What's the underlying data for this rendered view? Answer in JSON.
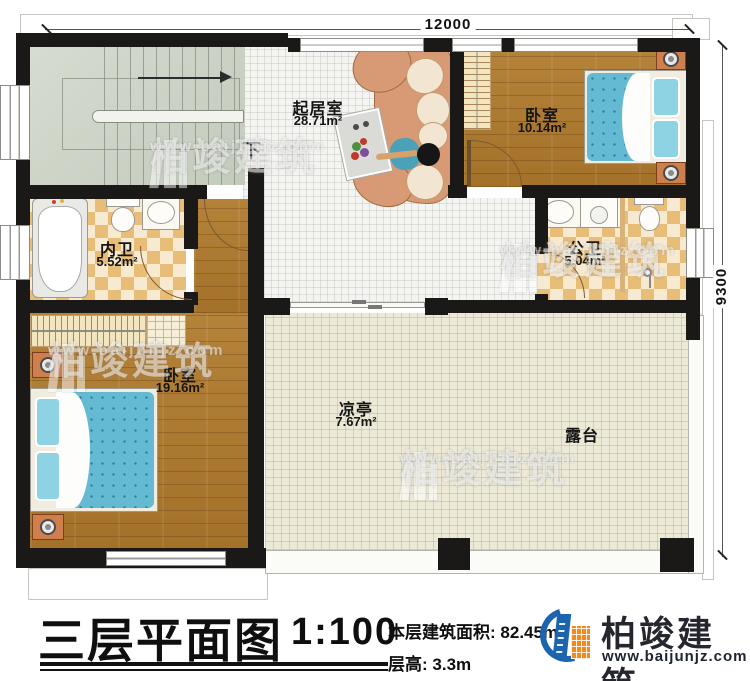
{
  "plan": {
    "dimensions": {
      "top": "12000",
      "right": "9300"
    },
    "stairs_label": "下",
    "rooms": {
      "living": {
        "name": "起居室",
        "area": "28.71m²"
      },
      "bedroom_top_right": {
        "name": "卧室",
        "area": "10.14m²"
      },
      "bath_inner": {
        "name": "内卫",
        "area": "5.52m²"
      },
      "bath_public": {
        "name": "公卫",
        "area": "5.04m²"
      },
      "bedroom_bottom_left": {
        "name": "卧室",
        "area": "19.16m²"
      },
      "pavilion": {
        "name": "凉亭",
        "area": "7.67m²"
      },
      "terrace": {
        "name": "露台"
      }
    }
  },
  "title_block": {
    "title": "三层平面图",
    "scale": "1:100",
    "area_label": "本层建筑面积:",
    "area_value": "82.45m²",
    "floor_height_label": "层高:",
    "floor_height_value": "3.3m"
  },
  "brand": {
    "name": "柏竣建筑",
    "website": "www.baijunjz.com"
  },
  "watermark": {
    "name": "柏竣建筑",
    "website": "www.baijunjz.com"
  },
  "colors": {
    "wall": "#1a1917",
    "wood_floor": "#ad7931",
    "bath_tile": "#e7bd77",
    "bath_tile_light": "#f7ead0",
    "terrace_floor": "#ece9d6",
    "stair_floor": "#ced5c9",
    "tile_floor": "#f4f4f1",
    "bed_blue": "#64bad2",
    "furniture_orange": "#cf7f4e",
    "sofa_salmon": "#d89a74",
    "brand_blue": "#1c64ad",
    "brand_orange": "#f28a1d"
  }
}
